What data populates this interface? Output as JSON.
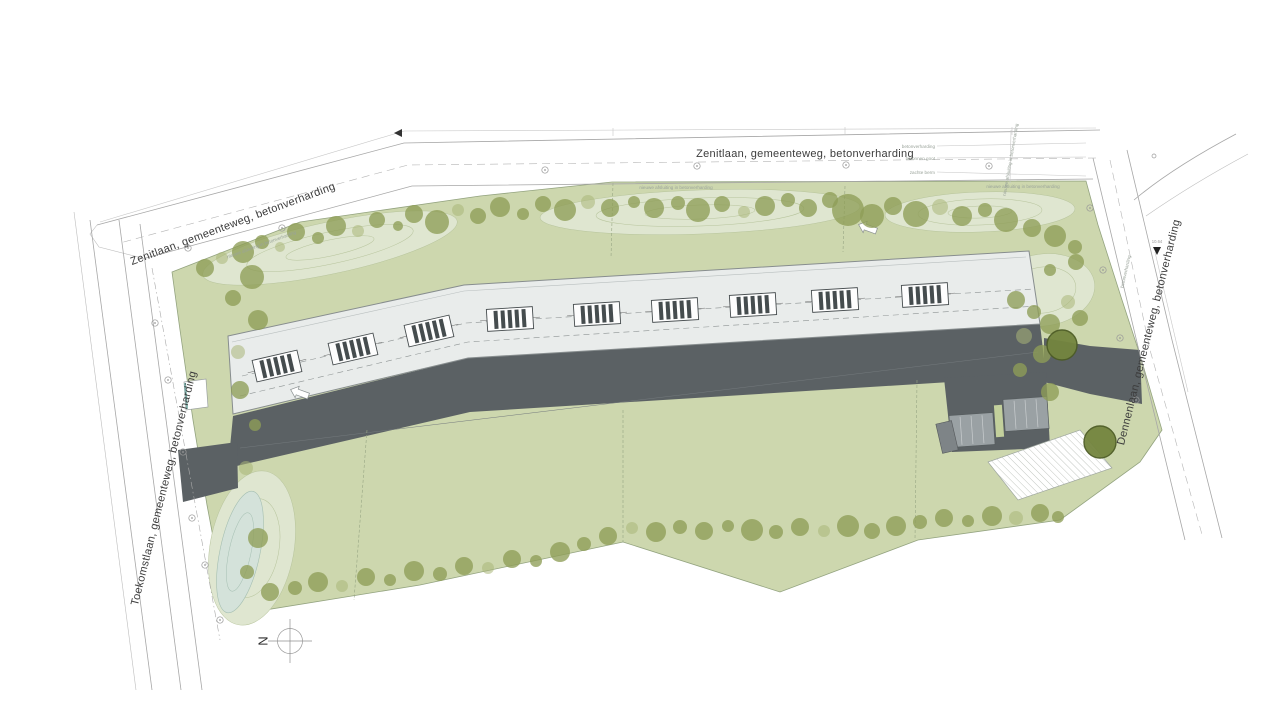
{
  "plan": {
    "north": "N",
    "roads": {
      "zenitlaan_top": "Zenitlaan, gemeenteweg, betonverharding",
      "zenitlaan_left": "Zenitlaan, gemeenteweg, betonverharding",
      "toekomstlaan": "Toekomstlaan, gemeenteweg, betonverharding",
      "dennenlaan": "Dennenlaan, gemeenteweg, betonverharding"
    },
    "annotations": {
      "betonverharding": "betonverharding",
      "betonnen_goot": "betonnen goot",
      "zachte_berm": "zachte berm",
      "nieuwe_afsluiting": "nieuwe afsluiting in betonverharding",
      "marker_value": "10.64"
    },
    "colors": {
      "field_green": "#cdd7ae",
      "mound_green": "#dfe6d0",
      "pond_blue": "#d4e2da",
      "tree_olive": "#8e9d57",
      "roof_grey": "#e9eceb",
      "road_dark": "#5b6164",
      "apron_grey": "#9aa1a4",
      "strip_green": "#c3d09c",
      "line_grey": "#a7a7a7"
    },
    "parcel_labels": [
      {
        "text": "1ste afdeling, sectie C, nr(s): 385f32 (deel)",
        "x": 490,
        "y": 243,
        "rot": -11
      },
      {
        "text": "1ste afdeling, sectie C, nr(s): 385f32 (deel)",
        "x": 793,
        "y": 235,
        "rot": -2
      },
      {
        "text": "1ste afdeling, sectie C, nr(s): 385f32 (deel)",
        "x": 765,
        "y": 459,
        "rot": 0
      },
      {
        "text": "1ste afdeling, sectie C, nr(s): 385f34 (deel)",
        "x": 432,
        "y": 503,
        "rot": -9
      },
      {
        "text": "1ste afdeling, sectie C, nr(s): 385y32",
        "x": 745,
        "y": 562,
        "rot": 0
      },
      {
        "text": "1ste afdeling, sectie C, nr(s): 385x32",
        "x": 435,
        "y": 603,
        "rot": -9
      },
      {
        "text": "1ste afdeling, sectie C, nr(s): 385m2 (deel)",
        "x": 1041,
        "y": 481,
        "rot": -14
      },
      {
        "text": "1ste afdeling, sectie C, nr(s): 385n2",
        "x": 1022,
        "y": 541,
        "rot": -10
      }
    ],
    "dim_labels": [
      {
        "t": "4.000",
        "x": 420,
        "y": 197,
        "rot": -8
      },
      {
        "t": "4.000",
        "x": 760,
        "y": 187,
        "rot": 0
      },
      {
        "t": "4.000",
        "x": 1048,
        "y": 192,
        "rot": 0
      }
    ],
    "trees": [
      [
        205,
        268,
        9,
        0
      ],
      [
        222,
        258,
        6,
        1
      ],
      [
        243,
        252,
        11,
        0
      ],
      [
        262,
        242,
        7,
        0
      ],
      [
        280,
        247,
        5,
        1
      ],
      [
        296,
        232,
        9,
        0
      ],
      [
        318,
        238,
        6,
        0
      ],
      [
        336,
        226,
        10,
        0
      ],
      [
        358,
        231,
        6,
        1
      ],
      [
        377,
        220,
        8,
        0
      ],
      [
        398,
        226,
        5,
        0
      ],
      [
        414,
        214,
        9,
        0
      ],
      [
        437,
        222,
        12,
        0
      ],
      [
        458,
        210,
        6,
        1
      ],
      [
        478,
        216,
        8,
        0
      ],
      [
        500,
        207,
        10,
        0
      ],
      [
        523,
        214,
        6,
        0
      ],
      [
        543,
        204,
        8,
        0
      ],
      [
        565,
        210,
        11,
        0
      ],
      [
        588,
        202,
        7,
        1
      ],
      [
        610,
        208,
        9,
        0
      ],
      [
        634,
        202,
        6,
        0
      ],
      [
        654,
        208,
        10,
        0
      ],
      [
        678,
        203,
        7,
        0
      ],
      [
        698,
        210,
        12,
        0
      ],
      [
        722,
        204,
        8,
        0
      ],
      [
        744,
        212,
        6,
        1
      ],
      [
        765,
        206,
        10,
        0
      ],
      [
        788,
        200,
        7,
        0
      ],
      [
        808,
        208,
        9,
        0
      ],
      [
        830,
        200,
        8,
        0
      ],
      [
        848,
        210,
        16,
        0
      ],
      [
        872,
        216,
        12,
        0
      ],
      [
        893,
        206,
        9,
        0
      ],
      [
        916,
        214,
        13,
        0
      ],
      [
        940,
        207,
        8,
        1
      ],
      [
        962,
        216,
        10,
        0
      ],
      [
        985,
        210,
        7,
        0
      ],
      [
        1006,
        220,
        12,
        0
      ],
      [
        1032,
        228,
        9,
        0
      ],
      [
        1055,
        236,
        11,
        0
      ],
      [
        1075,
        247,
        7,
        0
      ],
      [
        252,
        277,
        12,
        0
      ],
      [
        233,
        298,
        8,
        0
      ],
      [
        258,
        320,
        10,
        0
      ],
      [
        238,
        352,
        7,
        1
      ],
      [
        240,
        390,
        9,
        0
      ],
      [
        255,
        425,
        6,
        0
      ],
      [
        246,
        468,
        7,
        1
      ],
      [
        258,
        538,
        10,
        0
      ],
      [
        247,
        572,
        7,
        0
      ],
      [
        270,
        592,
        9,
        0
      ],
      [
        295,
        588,
        7,
        0
      ],
      [
        318,
        582,
        10,
        0
      ],
      [
        342,
        586,
        6,
        1
      ],
      [
        366,
        577,
        9,
        0
      ],
      [
        390,
        580,
        6,
        0
      ],
      [
        414,
        571,
        10,
        0
      ],
      [
        440,
        574,
        7,
        0
      ],
      [
        464,
        566,
        9,
        0
      ],
      [
        488,
        568,
        6,
        1
      ],
      [
        512,
        559,
        9,
        0
      ],
      [
        536,
        561,
        6,
        0
      ],
      [
        560,
        552,
        10,
        0
      ],
      [
        584,
        544,
        7,
        0
      ],
      [
        608,
        536,
        9,
        0
      ],
      [
        632,
        528,
        6,
        1
      ],
      [
        656,
        532,
        10,
        0
      ],
      [
        680,
        527,
        7,
        0
      ],
      [
        704,
        531,
        9,
        0
      ],
      [
        728,
        526,
        6,
        0
      ],
      [
        752,
        530,
        11,
        0
      ],
      [
        776,
        532,
        7,
        0
      ],
      [
        800,
        527,
        9,
        0
      ],
      [
        824,
        531,
        6,
        1
      ],
      [
        848,
        526,
        11,
        0
      ],
      [
        872,
        531,
        8,
        0
      ],
      [
        896,
        526,
        10,
        0
      ],
      [
        920,
        522,
        7,
        0
      ],
      [
        944,
        518,
        9,
        0
      ],
      [
        968,
        521,
        6,
        0
      ],
      [
        992,
        516,
        10,
        0
      ],
      [
        1016,
        518,
        7,
        1
      ],
      [
        1040,
        513,
        9,
        0
      ],
      [
        1058,
        517,
        6,
        0
      ],
      [
        1016,
        300,
        9,
        0
      ],
      [
        1034,
        312,
        7,
        0
      ],
      [
        1050,
        324,
        10,
        0
      ],
      [
        1024,
        336,
        8,
        1
      ],
      [
        1042,
        354,
        9,
        0
      ],
      [
        1020,
        370,
        7,
        0
      ],
      [
        1050,
        392,
        9,
        0
      ],
      [
        1068,
        302,
        7,
        1
      ],
      [
        1080,
        318,
        8,
        0
      ],
      [
        1076,
        262,
        8,
        0
      ],
      [
        1050,
        270,
        6,
        0
      ],
      [
        1062,
        345,
        15,
        2
      ],
      [
        1100,
        442,
        16,
        2
      ]
    ],
    "lamps": [
      [
        188,
        248
      ],
      [
        282,
        228
      ],
      [
        545,
        170
      ],
      [
        697,
        166
      ],
      [
        846,
        165
      ],
      [
        989,
        166
      ],
      [
        155,
        323
      ],
      [
        168,
        380
      ],
      [
        183,
        452
      ],
      [
        192,
        518
      ],
      [
        205,
        565
      ],
      [
        220,
        620
      ],
      [
        1090,
        208
      ],
      [
        1103,
        270
      ],
      [
        1120,
        338
      ],
      [
        1136,
        400
      ]
    ],
    "skylights": [
      [
        277,
        366,
        -13
      ],
      [
        353,
        349,
        -13
      ],
      [
        429,
        331,
        -13
      ],
      [
        510,
        319,
        -3.5
      ],
      [
        597,
        314,
        -3.5
      ],
      [
        675,
        310,
        -3.5
      ],
      [
        753,
        305,
        -3.5
      ],
      [
        835,
        300,
        -3.5
      ],
      [
        925,
        295,
        -3.5
      ]
    ],
    "units": [
      [
        287,
        401,
        -13.4
      ],
      [
        357,
        384,
        -13.4
      ],
      [
        427,
        368,
        -13.4
      ],
      [
        503,
        356,
        -3.4
      ],
      [
        578,
        351,
        -3.4
      ],
      [
        653,
        347,
        -3.4
      ],
      [
        729,
        342,
        -3.4
      ],
      [
        806,
        338,
        -3.4
      ],
      [
        884,
        333,
        -3.4
      ]
    ],
    "doors": [
      [
        322,
        393,
        -13.4
      ],
      [
        392,
        376,
        -13.4
      ],
      [
        465,
        359,
        -8
      ],
      [
        540,
        354,
        -3.4
      ],
      [
        615,
        349,
        -3.4
      ],
      [
        691,
        345,
        -3.4
      ],
      [
        767,
        340,
        -3.4
      ],
      [
        845,
        336,
        -3.4
      ]
    ]
  }
}
